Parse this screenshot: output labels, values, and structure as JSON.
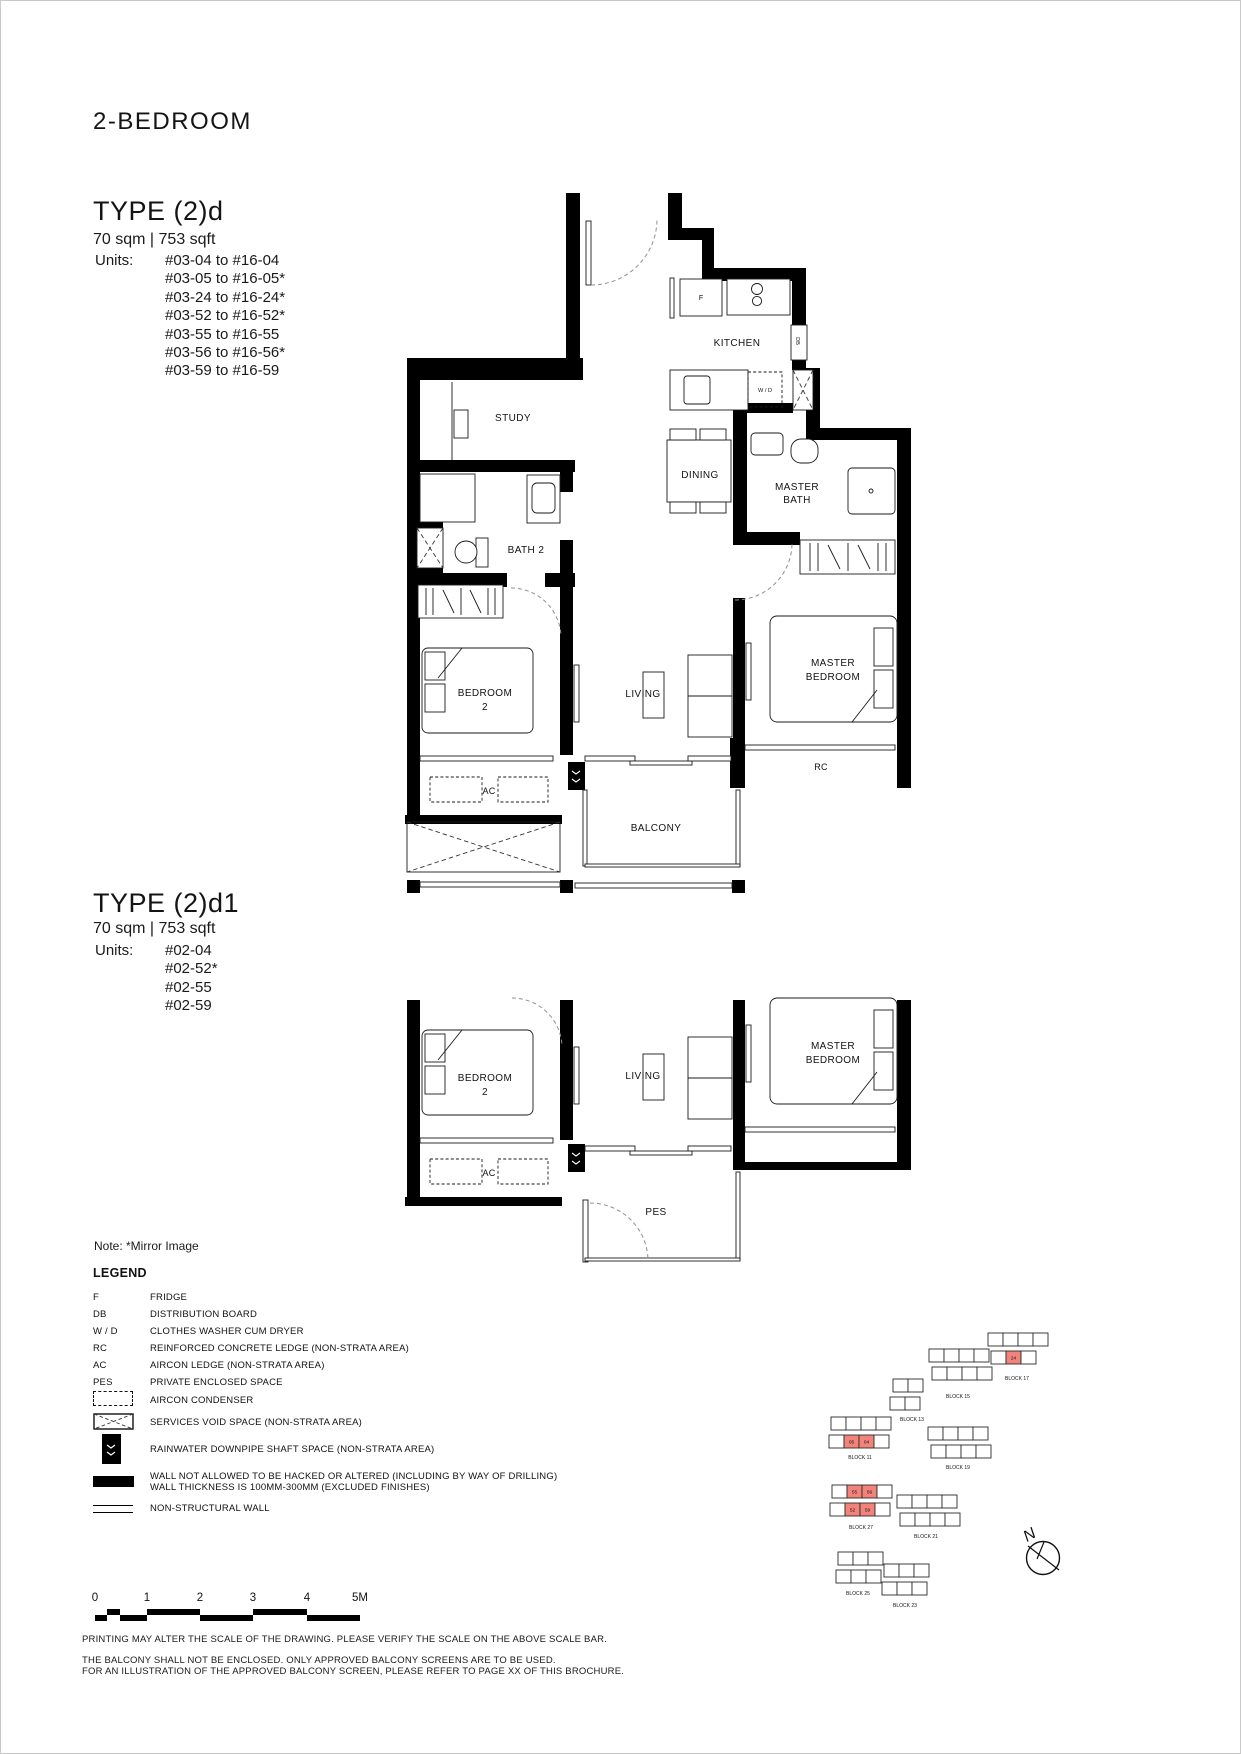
{
  "page": {
    "title": "2-BEDROOM",
    "note": "Note: *Mirror Image"
  },
  "type_d": {
    "title": "TYPE (2)d",
    "area": "70 sqm | 753 sqft",
    "units_label": "Units:",
    "units": [
      "#03-04 to #16-04",
      "#03-05 to #16-05*",
      "#03-24 to #16-24*",
      "#03-52 to #16-52*",
      "#03-55 to #16-55",
      "#03-56 to #16-56*",
      "#03-59 to #16-59"
    ]
  },
  "type_d1": {
    "title": "TYPE (2)d1",
    "area": "70 sqm | 753 sqft",
    "units_label": "Units:",
    "units": [
      "#02-04",
      "#02-52*",
      "#02-55",
      "#02-59"
    ]
  },
  "plan_labels": {
    "kitchen": "KITCHEN",
    "fridge": "F",
    "db": "DB",
    "wd": "W / D",
    "study": "STUDY",
    "dining": "DINING",
    "master": "MASTER",
    "bath": "BATH",
    "bath2": "BATH 2",
    "bedroom": "BEDROOM",
    "two": "2",
    "living": "LIVING",
    "rc": "RC",
    "ac": "AC",
    "balcony": "BALCONY",
    "pes": "PES"
  },
  "legend": {
    "title": "LEGEND",
    "items": [
      {
        "abbr": "F",
        "desc": "FRIDGE"
      },
      {
        "abbr": "DB",
        "desc": "DISTRIBUTION BOARD"
      },
      {
        "abbr": "W / D",
        "desc": "CLOTHES WASHER CUM DRYER"
      },
      {
        "abbr": "RC",
        "desc": "REINFORCED CONCRETE LEDGE (NON-STRATA AREA)"
      },
      {
        "abbr": "AC",
        "desc": "AIRCON LEDGE (NON-STRATA AREA)"
      },
      {
        "abbr": "PES",
        "desc": "PRIVATE ENCLOSED SPACE"
      }
    ],
    "symbols": [
      {
        "name": "aircon-condenser-symbol",
        "desc": "AIRCON CONDENSER"
      },
      {
        "name": "services-void-symbol",
        "desc": "SERVICES VOID SPACE (NON-STRATA AREA)"
      },
      {
        "name": "rainwater-downpipe-symbol",
        "desc": "RAINWATER DOWNPIPE SHAFT SPACE (NON-STRATA AREA)"
      },
      {
        "name": "structural-wall-symbol",
        "desc": "WALL NOT ALLOWED TO BE HACKED OR ALTERED (INCLUDING BY WAY OF DRILLING)",
        "desc2": "WALL THICKNESS IS 100MM-300MM (EXCLUDED FINISHES)"
      },
      {
        "name": "non-structural-wall-symbol",
        "desc": "NON-STRUCTURAL WALL"
      }
    ]
  },
  "scale_bar": {
    "ticks": [
      "0",
      "1",
      "2",
      "3",
      "4",
      "5M"
    ]
  },
  "disclaimer": {
    "line1": "PRINTING MAY ALTER THE SCALE OF THE DRAWING. PLEASE VERIFY THE SCALE ON THE ABOVE SCALE BAR.",
    "line2": "THE BALCONY SHALL NOT BE ENCLOSED. ONLY APPROVED BALCONY SCREENS ARE TO BE USED.",
    "line3": "FOR AN ILLUSTRATION OF THE APPROVED BALCONY SCREEN, PLEASE REFER TO PAGE XX OF THIS BROCHURE."
  },
  "compass": {
    "label": "N"
  },
  "site_map": {
    "highlight_color": "#f2837b",
    "blocks": [
      {
        "label": "BLOCK 17",
        "lx": 1017,
        "ly": 1380,
        "rows": [
          {
            "x": 988,
            "y": 1333,
            "n": 4
          },
          {
            "x": 991,
            "y": 1351,
            "n": 3,
            "red": {
              "1": "24"
            }
          }
        ]
      },
      {
        "label": "BLOCK 15",
        "lx": 958,
        "ly": 1398,
        "rows": [
          {
            "x": 929,
            "y": 1349,
            "n": 4
          },
          {
            "x": 932,
            "y": 1367,
            "n": 4
          }
        ]
      },
      {
        "label": "BLOCK 13",
        "lx": 912,
        "ly": 1421,
        "rows": [
          {
            "x": 893,
            "y": 1379,
            "n": 2
          },
          {
            "x": 890,
            "y": 1397,
            "n": 2
          }
        ]
      },
      {
        "label": "BLOCK 11",
        "lx": 860,
        "ly": 1459,
        "rows": [
          {
            "x": 831,
            "y": 1417,
            "n": 4
          },
          {
            "x": 829,
            "y": 1435,
            "n": 4,
            "red": {
              "1": "05",
              "2": "04"
            }
          }
        ]
      },
      {
        "label": "BLOCK 19",
        "lx": 958,
        "ly": 1469,
        "rows": [
          {
            "x": 928,
            "y": 1427,
            "n": 4
          },
          {
            "x": 931,
            "y": 1445,
            "n": 4
          }
        ]
      },
      {
        "label": "BLOCK 27",
        "lx": 861,
        "ly": 1529,
        "rows": [
          {
            "x": 832,
            "y": 1485,
            "n": 4,
            "red": {
              "1": "55",
              "2": "56"
            }
          },
          {
            "x": 830,
            "y": 1503,
            "n": 4,
            "red": {
              "1": "52",
              "2": "59"
            }
          }
        ]
      },
      {
        "label": "BLOCK 21",
        "lx": 926,
        "ly": 1538,
        "rows": [
          {
            "x": 897,
            "y": 1495,
            "n": 4
          },
          {
            "x": 900,
            "y": 1513,
            "n": 4
          }
        ]
      },
      {
        "label": "BLOCK 25",
        "lx": 858,
        "ly": 1595,
        "rows": [
          {
            "x": 838,
            "y": 1552,
            "n": 3
          },
          {
            "x": 836,
            "y": 1570,
            "n": 3
          }
        ]
      },
      {
        "label": "BLOCK 23",
        "lx": 905,
        "ly": 1607,
        "rows": [
          {
            "x": 884,
            "y": 1564,
            "n": 3
          },
          {
            "x": 882,
            "y": 1582,
            "n": 3
          }
        ]
      }
    ]
  }
}
